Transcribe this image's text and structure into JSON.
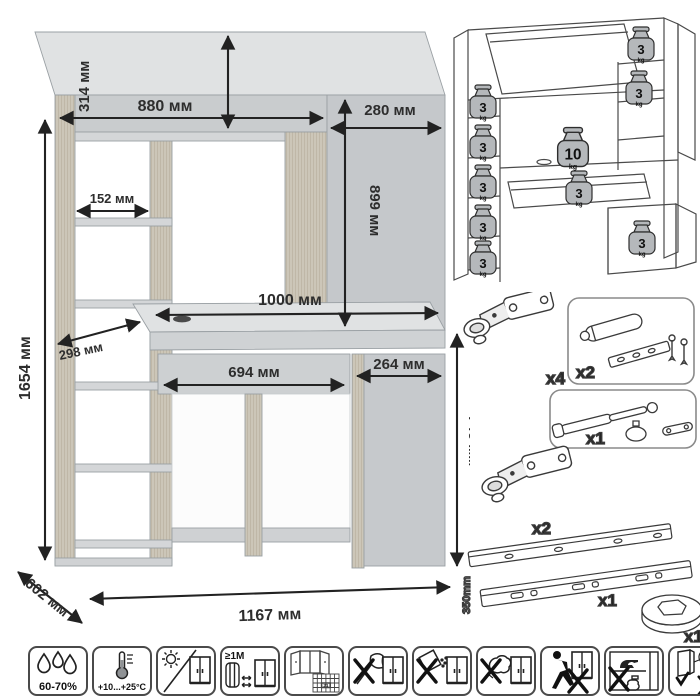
{
  "dims": {
    "total_height": "1654 мм",
    "hutch_height": "314 мм",
    "hutch_width": "880 мм",
    "side_width": "280 мм",
    "side_height": "899 мм",
    "shelf_width": "152 мм",
    "desktop_width": "1000 мм",
    "shelf_depth": "298 мм",
    "drawer_width": "694 мм",
    "pedestal_width": "264 мм",
    "desk_height": "746 мм",
    "depth": "602 мм",
    "total_width": "1167 мм"
  },
  "load": {
    "weights": [
      {
        "value": "3",
        "unit": "kg"
      },
      {
        "value": "3",
        "unit": "kg"
      },
      {
        "value": "3",
        "unit": "kg"
      },
      {
        "value": "3",
        "unit": "kg"
      },
      {
        "value": "3",
        "unit": "kg"
      },
      {
        "value": "3",
        "unit": "kg"
      },
      {
        "value": "3",
        "unit": "kg"
      },
      {
        "value": "10",
        "unit": "kg"
      },
      {
        "value": "3",
        "unit": "kg"
      },
      {
        "value": "3",
        "unit": "kg"
      }
    ]
  },
  "hardware": {
    "hinge_top_qty": "x4",
    "damper_qty": "x2",
    "gas_lift_qty": "x1",
    "hinge_bottom_qty": "x2",
    "slides_qty": "x1",
    "slides_length": "350mm",
    "grommet_qty": "x1"
  },
  "care": {
    "humidity": "60-70%",
    "temperature": "+10...+25°C",
    "distance": "≥1M",
    "calendar_day": "21"
  }
}
